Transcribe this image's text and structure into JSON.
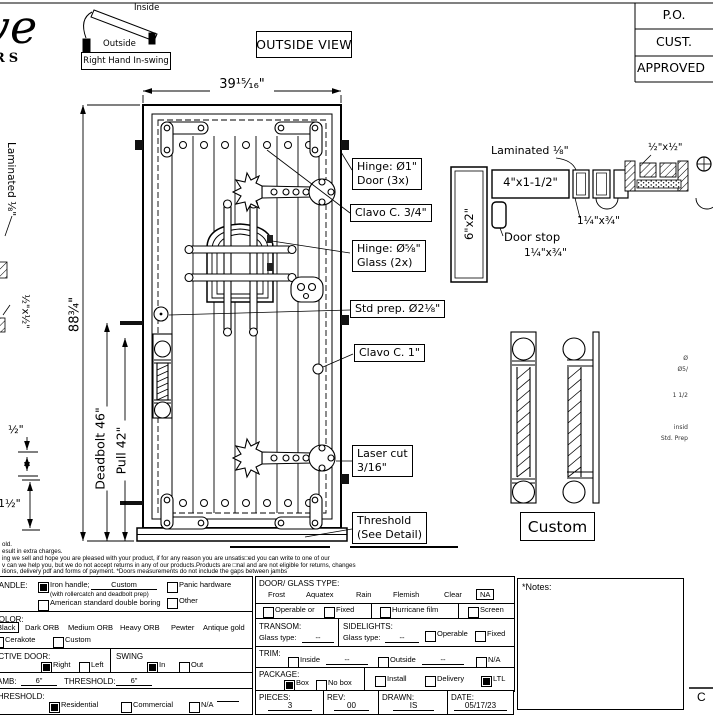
{
  "sheet": {
    "logo": {
      "script": "ve",
      "sub": "RS"
    },
    "swing": {
      "inside": "Inside",
      "outside": "Outside",
      "caption": "Right Hand In-swing"
    },
    "view_label": "OUTSIDE VIEW",
    "title_block": {
      "po": "P.O.",
      "cust": "CUST.",
      "approved": "APPROVED"
    },
    "corner_letter": "C"
  },
  "door": {
    "width": "39¹⁵⁄₁₆\"",
    "height": "88¾\"",
    "deadbolt": "Deadbolt 46\"",
    "pull": "Pull 42\"",
    "callouts": {
      "hinge_door_1": "Hinge: Ø1\"",
      "hinge_door_2": "Door (3x)",
      "clavo_small": "Clavo C. 3/4\"",
      "hinge_glass_1": "Hinge: Ø⅝\"",
      "hinge_glass_2": "Glass (2x)",
      "std_prep": "Std prep. Ø2⅛\"",
      "clavo_large": "Clavo C. 1\"",
      "laser_1": "Laser cut",
      "laser_2": "3/16\"",
      "threshold_1": "Threshold",
      "threshold_2": "(See Detail)"
    }
  },
  "details": {
    "laminated_left": "Laminated ⅛\"",
    "half_left": "½\"x½\"",
    "dim_half": "½\"",
    "dim_one_half": "1½\"",
    "laminated_right": "Laminated ⅛\"",
    "jamb_size": "4\"x1-1/2\"",
    "post_size": "6\"x2\"",
    "stop_size_a": "1¼\"x¾\"",
    "door_stop": "Door stop",
    "stop_size_b": "1¼\"x¾\"",
    "half_right": "½\"x½\"",
    "handle_label": "Custom",
    "fragments": [
      "Ø",
      "Ø5/",
      "1 1/2",
      "insid",
      "Std. Prep"
    ]
  },
  "fine_print": {
    "lines": [
      "old.",
      "esult in extra charges.",
      "ing we sell and hope you are pleased with your product, if for any reason you are unsatis□ed you can write to one of our",
      "v can we help you, but we do not accept returns in any of our products.Products are □nal and are not eligible for returns, changes",
      "itions, delivery pdf and forms of payment. *Doors measurements do not include the gaps between jambs"
    ]
  },
  "form": {
    "handle": {
      "label": "HANDLE:",
      "iron": "Iron handle;",
      "iron_value": "Custom",
      "iron_note": "(with rollercatch and deadbolt prep)",
      "american": "American standard double boring",
      "panic": "Panic hardware",
      "other": "Other"
    },
    "color": {
      "label": "COLOR:",
      "black": "Black",
      "dark_orb": "Dark ORB",
      "medium_orb": "Medium ORB",
      "heavy_orb": "Heavy ORB",
      "pewter": "Pewter",
      "antique_gold": "Antique gold",
      "cerakote": "Cerakote",
      "custom": "Custom"
    },
    "active_door": {
      "label": "ACTIVE DOOR:",
      "right": "Right",
      "left": "Left"
    },
    "swing": {
      "label": "SWING",
      "in": "In",
      "out": "Out"
    },
    "jamb": {
      "label": "JAMB:",
      "value": "6\"",
      "threshold_label": "THRESHOLD:",
      "threshold_value": "6\""
    },
    "threshold": {
      "label": "THRESHOLD:",
      "residential": "Residential",
      "commercial": "Commercial",
      "na": "N/A"
    },
    "glass": {
      "label": "DOOR/ GLASS TYPE:",
      "frost": "Frost",
      "aquatex": "Aquatex",
      "rain": "Rain",
      "flemish": "Flemish",
      "clear": "Clear",
      "na": "NA",
      "operable": "Operable  or",
      "fixed": "Fixed",
      "hurricane": "Hurricane film",
      "screen": "Screen"
    },
    "transom": {
      "label": "TRANSOM:",
      "glass_type": "Glass type:",
      "value": "--"
    },
    "sidelights": {
      "label": "SIDELIGHTS:",
      "glass_type": "Glass type:",
      "value": "--",
      "operable": "Operable",
      "fixed": "Fixed"
    },
    "trim": {
      "label": "TRIM:",
      "inside": "Inside",
      "inside_value": "--",
      "outside": "Outside",
      "outside_value": "--",
      "na": "N/A"
    },
    "package": {
      "label": "PACKAGE:",
      "box": "Box",
      "no_box": "No box",
      "install": "Install",
      "delivery": "Delivery",
      "ltl": "LTL"
    },
    "meta": {
      "pieces_label": "PIECES:",
      "pieces": "3",
      "rev_label": "REV:",
      "rev": "00",
      "drawn_label": "DRAWN:",
      "drawn": "IS",
      "date_label": "DATE:",
      "date": "05/17/23"
    },
    "notes_label": "*Notes:",
    "checked": {
      "iron_handle": true,
      "black": true,
      "active_right": true,
      "swing_in": true,
      "threshold_residential": true,
      "glass_na": true,
      "package_box": true,
      "package_ltl": true
    }
  }
}
